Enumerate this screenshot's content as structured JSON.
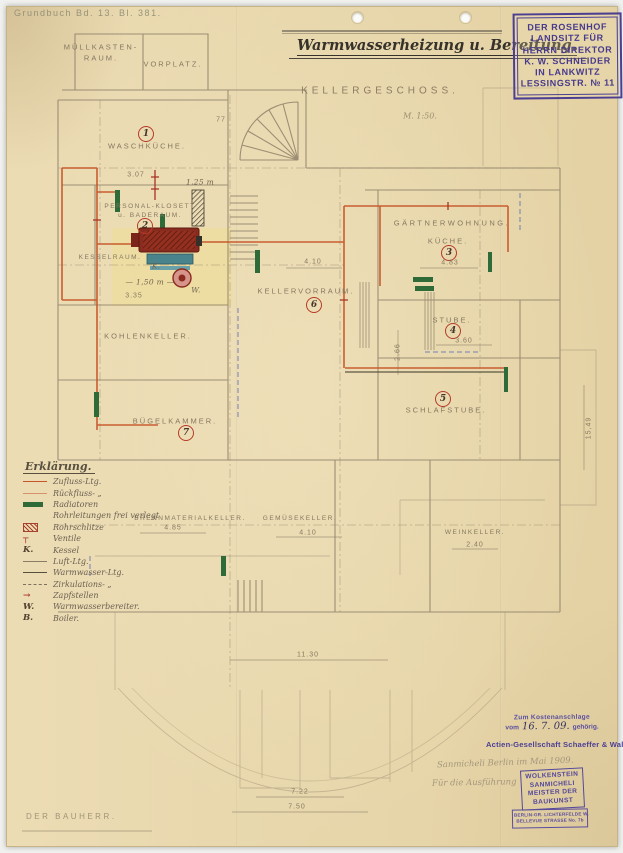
{
  "header": {
    "grundbuch": "Grundbuch Bd. 13. Bl. 381.",
    "title": "Warmwasserheizung u. Bereitung.",
    "floor": "KELLERGESCHOSS.",
    "scale": "M. 1:50."
  },
  "owner_stamp": {
    "lines": [
      "DER ROSENHOF",
      "LANDSITZ FÜR",
      "HERRN DIREKTOR",
      "K. W. SCHNEIDER",
      "IN LANKWITZ",
      "LESSINGSTR. № 11"
    ]
  },
  "rooms": {
    "muellkasten": {
      "name": "MÜLLKASTEN-",
      "name2": "RAUM."
    },
    "vorplatz": {
      "name": "VORPLATZ."
    },
    "waschkueche": {
      "no": "1",
      "name": "WASCHKÜCHE."
    },
    "klosett": {
      "no": "2",
      "name": "PERSONAL-KLOSETT",
      "name2": "u. BADERAUM."
    },
    "kesselraum": {
      "name": "KESSELRAUM.",
      "k": "K.",
      "w": "W."
    },
    "gaertnerwohnung": {
      "name": "GÄRTNERWOHNUNG."
    },
    "kueche": {
      "no": "3",
      "name": "KÜCHE."
    },
    "stube": {
      "no": "4",
      "name": "STUBE."
    },
    "schlafstube": {
      "no": "5",
      "name": "SCHLAFSTUBE."
    },
    "kellervorraum": {
      "no": "6",
      "name": "KELLERVORRAUM."
    },
    "kohlenkeller": {
      "name": "KOHLENKELLER."
    },
    "buegelkammer": {
      "no": "7",
      "name": "BÜGELKAMMER."
    },
    "brennkeller": {
      "name": "BRENNMATERIALKELLER."
    },
    "gemuesekeller": {
      "name": "GEMÜSEKELLER."
    },
    "weinkeller": {
      "name": "WEINKELLER."
    }
  },
  "dims": {
    "wasch_w": "3.07",
    "muell_h": "77",
    "pipe_len": "1,25 m",
    "kessel_len": "— 1,50 m —",
    "kessel_w": "3.35",
    "kvr_w": "4.10",
    "kueche_w": "4.83",
    "stube_w": "3.60",
    "stube_h": "2.66",
    "brenn_w": "4.85",
    "gemuese_w": "4.10",
    "wein_w": "2.40",
    "bottom_w1": "11.30",
    "bottom_w2": "7.22",
    "bottom_w3": "7.50",
    "right_h": "15,49"
  },
  "legend": {
    "title": "Erklärung.",
    "entries": [
      {
        "sym": "",
        "label": "Zufluss-Ltg."
      },
      {
        "sym": "",
        "label": "Rückfluss- „"
      },
      {
        "sym": "",
        "label": "Radiatoren"
      },
      {
        "sym": "",
        "label": "Rohrleitungen frei verlegt"
      },
      {
        "sym": "",
        "label": "Rohrschlitze"
      },
      {
        "sym": "┬",
        "label": "Ventile"
      },
      {
        "sym": "K.",
        "label": "Kessel"
      },
      {
        "sym": "",
        "label": "Luft-Ltg."
      },
      {
        "sym": "",
        "label": "Warmwasser-Ltg."
      },
      {
        "sym": "",
        "label": "Zirkulations- „"
      },
      {
        "sym": "→",
        "label": "Zapfstellen"
      },
      {
        "sym": "W.",
        "label": "Warmwasserbereiter."
      },
      {
        "sym": "B.",
        "label": "Boiler."
      }
    ]
  },
  "footer": {
    "cost_line1": "Zum Kostenanschlage",
    "cost_pre": "vom",
    "cost_date": "16. 7. 09.",
    "cost_post": "gehörig.",
    "company": "Actien-Gesellschaft Schaeffer & Walcker",
    "note1": "Sanmicheli   Berlin im Mai 1909.",
    "note2": "Für die Ausführung",
    "architect_stamp": [
      "WOLKENSTEIN",
      "SANMICHELI",
      "MEISTER DER",
      "BAUKUNST"
    ],
    "address_stamp": [
      "BERLIN-GR. LICHTERFELDE W.",
      "BELLEVUE STRASSE No. 7b"
    ],
    "bauherr": "DER BAUHERR."
  }
}
